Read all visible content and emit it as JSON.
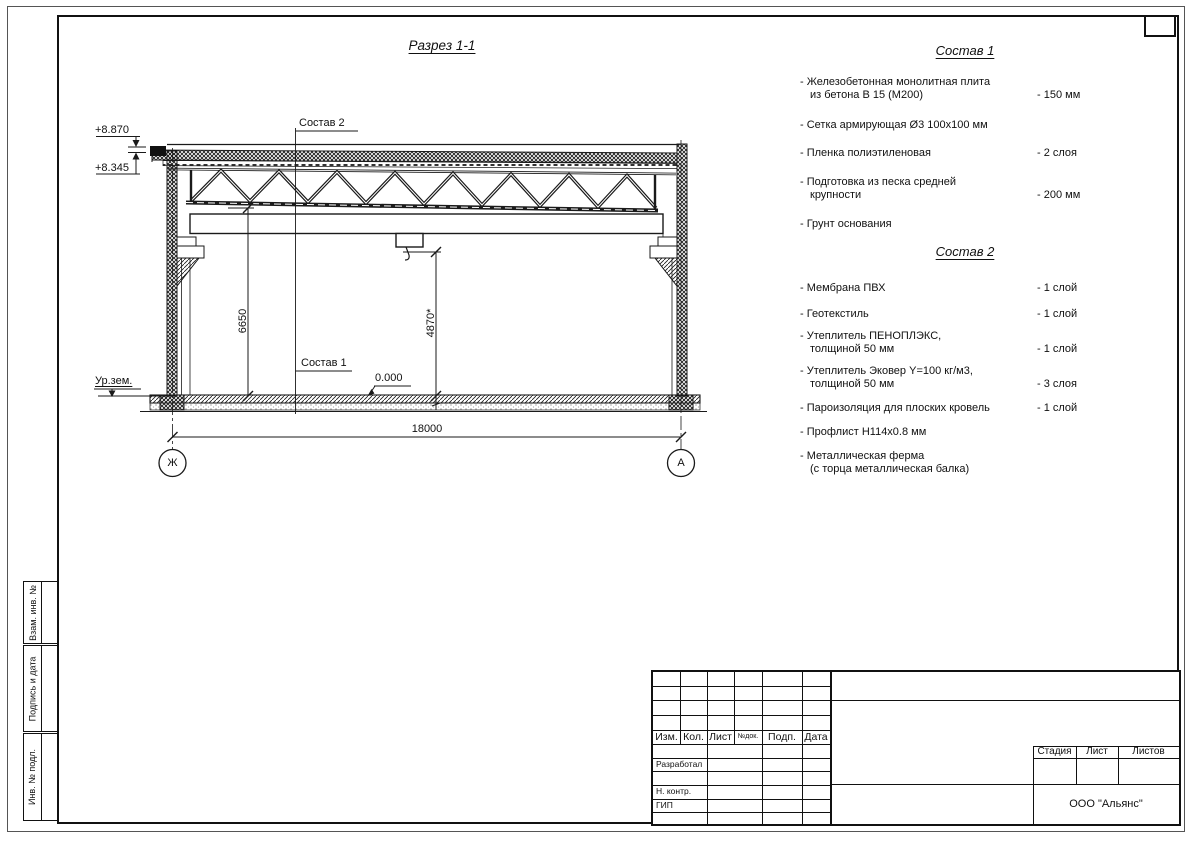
{
  "drawing": {
    "title": "Разрез 1-1",
    "sostav1_callout": "Состав 1",
    "sostav2_callout": "Состав 2",
    "level_top": "+8.870",
    "level_eaves": "+8.345",
    "level_floor": "0.000",
    "ground_label": "Ур.зем.",
    "dim_height": "6650",
    "dim_hook": "4870*",
    "dim_span": "18000",
    "axis_left": "Ж",
    "axis_right": "А"
  },
  "sostav1": {
    "title": "Состав 1",
    "items": [
      {
        "name": "- Железобетонная  монолитная плита\nиз бетона В 15 (М200)",
        "value": "- 150 мм"
      },
      {
        "name": "- Сетка армирующая Ø3 100х100 мм",
        "value": ""
      },
      {
        "name": "- Пленка полиэтиленовая",
        "value": "- 2 слоя"
      },
      {
        "name": "- Подготовка из песка средней\nкрупности",
        "value": "- 200 мм"
      },
      {
        "name": "- Грунт основания",
        "value": ""
      }
    ]
  },
  "sostav2": {
    "title": "Состав 2",
    "items": [
      {
        "name": "- Мембрана ПВХ",
        "value": "- 1 слой"
      },
      {
        "name": "- Геотекстиль",
        "value": "- 1 слой"
      },
      {
        "name": "- Утеплитель ПЕНОПЛЭКС,\nтолщиной 50 мм",
        "value": "- 1 слой"
      },
      {
        "name": "- Утеплитель Эковер Y=100 кг/м3,\nтолщиной 50 мм",
        "value": "- 3 слоя"
      },
      {
        "name": "- Пароизоляция для плоских кровель",
        "value": "- 1 слой"
      },
      {
        "name": "- Профлист Н114х0.8 мм",
        "value": ""
      },
      {
        "name": "- Металлическая ферма\n(с торца металлическая балка)",
        "value": ""
      }
    ]
  },
  "titleblock": {
    "header": [
      "Изм.",
      "Кол.",
      "Лист",
      "№док.",
      "Подп.",
      "Дата"
    ],
    "roles": [
      "Разработал",
      "Н. контр.",
      "ГИП"
    ],
    "stage_header": [
      "Стадия",
      "Лист",
      "Листов"
    ],
    "company": "ООО \"Альянс\""
  },
  "side_stamps": [
    "Взам. инв. №",
    "Подпись и дата",
    "Инв. № подл."
  ]
}
